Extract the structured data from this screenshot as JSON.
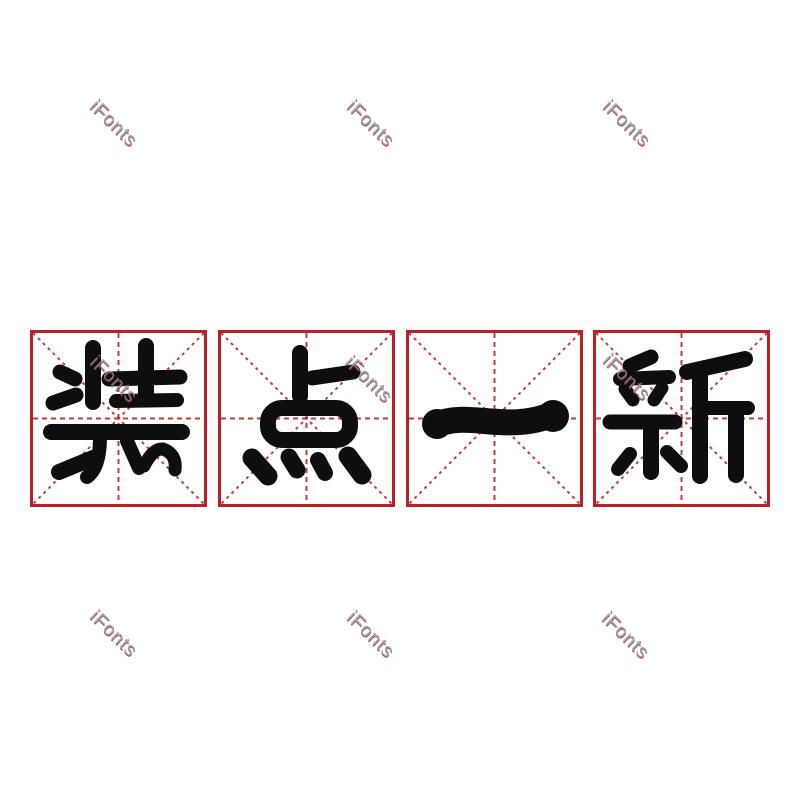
{
  "meta": {
    "phrase": "装点一新",
    "description": "four bold rounded Chinese characters inside red rice-character practice grids"
  },
  "theme": {
    "grid_red": "#bb2027",
    "ink_black": "#0e0e0e",
    "watermark_gray": "#90969b",
    "watermark_red": "#93222e",
    "background": "#ffffff"
  },
  "grid": {
    "cells": [
      {
        "char": "装"
      },
      {
        "char": "点"
      },
      {
        "char": "一"
      },
      {
        "char": "新"
      }
    ]
  },
  "watermark": {
    "text": "iFonts"
  }
}
